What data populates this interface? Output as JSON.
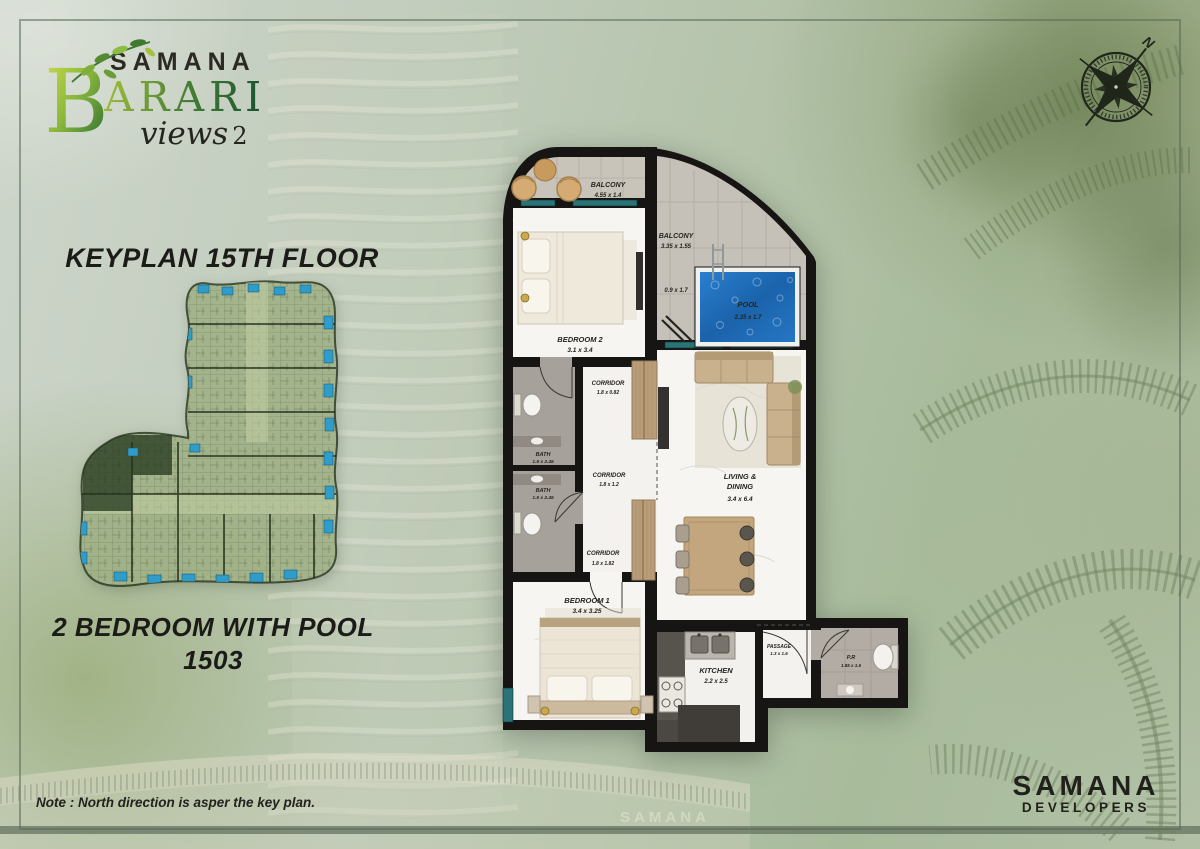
{
  "logo": {
    "brand": "SAMANA",
    "name_initial": "B",
    "name_rest": "ARARI",
    "script": "views",
    "script_number": "2"
  },
  "keyplan": {
    "title": "KEYPLAN 15TH FLOOR"
  },
  "unit": {
    "title": "2 BEDROOM WITH POOL",
    "number": "1503"
  },
  "note": {
    "text": "Note : North direction is asper the key plan."
  },
  "compass": {
    "north": "N"
  },
  "developer": {
    "name": "SAMANA",
    "division": "DEVELOPERS"
  },
  "background": {
    "building_sign": "SAMANA"
  },
  "floorplan": {
    "rooms": {
      "balcony_top": {
        "name": "BALCONY",
        "dims": "4.55 x 1.4"
      },
      "balcony_pool": {
        "name": "BALCONY",
        "dims": "3.35 x 1.55"
      },
      "balcony_side": {
        "dims": "0.9 x 1.7"
      },
      "pool": {
        "name": "POOL",
        "dims": "2.35 x 1.7"
      },
      "bedroom2": {
        "name": "BEDROOM 2",
        "dims": "3.1 x 3.4"
      },
      "bath_upper": {
        "name": "BATH",
        "dims": "1.5 x 2.45"
      },
      "bath_lower": {
        "name": "BATH",
        "dims": "1.5 x 2.45"
      },
      "corridor_upper": {
        "name": "CORRIDOR",
        "dims": "1.8 x 0.82"
      },
      "corridor_middle": {
        "name": "CORRIDOR",
        "dims": "1.8 x 1.2"
      },
      "corridor_lower": {
        "name": "CORRIDOR",
        "dims": "1.8 x 1.82"
      },
      "living": {
        "name_line1": "LIVING &",
        "name_line2": "DINING",
        "dims": "3.4 x 6.4"
      },
      "bedroom1": {
        "name": "BEDROOM 1",
        "dims": "3.4 x 3.25"
      },
      "kitchen": {
        "name": "KITCHEN",
        "dims": "2.2 x 2.5"
      },
      "passage": {
        "name": "PASSAGE",
        "dims": "1.3 x 1.6"
      },
      "powder_room": {
        "name": "P.R",
        "dims": "1.85 x 1.6"
      }
    }
  },
  "colors": {
    "pool_blue": "#1f6cb4",
    "window_teal": "#2a7477",
    "logo_green_light": "#a6c13c",
    "logo_green_dark": "#1b5a33",
    "wall_black": "#161513"
  }
}
